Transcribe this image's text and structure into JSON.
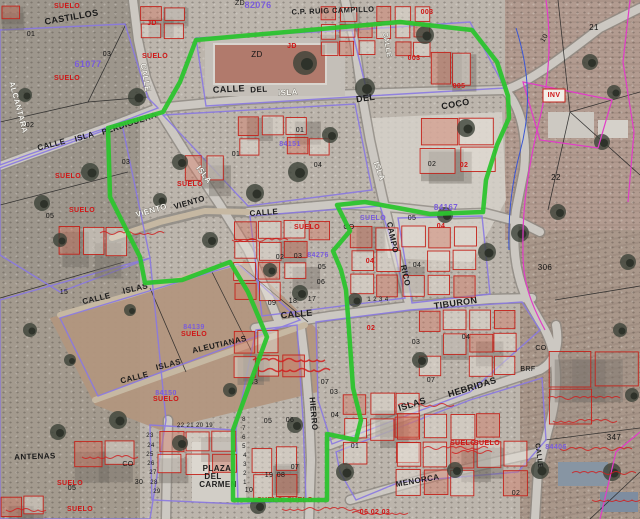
{
  "map": {
    "description": "Cadastral parcel overlay on aerial orthophoto",
    "boundary_color_green": "#2cc42e",
    "building_outline_color": "#c4231b",
    "block_outline_color": "#8a79e2",
    "annotation_magenta": "#e23cc8",
    "annotation_blue": "#3a56d4",
    "labels": [
      {
        "t": "CASTILLOS",
        "x": 72,
        "y": 20,
        "r": -10,
        "c": "st",
        "s": 9
      },
      {
        "t": "CALLE",
        "x": 52,
        "y": 147,
        "r": -14,
        "c": "st",
        "s": 8
      },
      {
        "t": "ISLA",
        "x": 85,
        "y": 139,
        "r": -16,
        "c": "st",
        "s": 8
      },
      {
        "t": "PERDIGUERA",
        "x": 130,
        "y": 126,
        "r": -18,
        "c": "st",
        "s": 8
      },
      {
        "t": "CALLE",
        "x": 229,
        "y": 92,
        "r": -3,
        "c": "st",
        "s": 9
      },
      {
        "t": "DEL",
        "x": 259,
        "y": 92,
        "r": -3,
        "c": "st",
        "s": 8
      },
      {
        "t": "DEL",
        "x": 366,
        "y": 101,
        "r": -8,
        "c": "st",
        "s": 9
      },
      {
        "t": "COCO",
        "x": 456,
        "y": 107,
        "r": -10,
        "c": "st",
        "s": 9
      },
      {
        "t": "TIBURON",
        "x": 456,
        "y": 306,
        "r": -8,
        "c": "st",
        "s": 9
      },
      {
        "t": "CALLE",
        "x": 297,
        "y": 317,
        "r": -5,
        "c": "st",
        "s": 9
      },
      {
        "t": "ISLAS",
        "x": 413,
        "y": 407,
        "r": -17,
        "c": "st",
        "s": 9
      },
      {
        "t": "HEBRIDAS",
        "x": 473,
        "y": 390,
        "r": -17,
        "c": "st",
        "s": 9
      },
      {
        "t": "CALLE",
        "x": 97,
        "y": 301,
        "r": -13,
        "c": "st",
        "s": 8
      },
      {
        "t": "ISLAS",
        "x": 136,
        "y": 291,
        "r": -13,
        "c": "st",
        "s": 8
      },
      {
        "t": "CALLE",
        "x": 135,
        "y": 380,
        "r": -14,
        "c": "st",
        "s": 8
      },
      {
        "t": "ISLAS",
        "x": 169,
        "y": 367,
        "r": -14,
        "c": "st",
        "s": 8
      },
      {
        "t": "ALEUTIANAS",
        "x": 220,
        "y": 347,
        "r": -13,
        "c": "st",
        "s": 8
      },
      {
        "t": "VIENTO",
        "x": 190,
        "y": 205,
        "r": -16,
        "c": "st",
        "s": 8
      },
      {
        "t": "CALLE",
        "x": 264,
        "y": 215,
        "r": -4,
        "c": "st",
        "s": 8
      },
      {
        "t": "HIERRO",
        "x": 311,
        "y": 414,
        "r": 85,
        "c": "st",
        "s": 8
      },
      {
        "t": "CAMPO",
        "x": 390,
        "y": 238,
        "r": 78,
        "c": "st",
        "s": 8
      },
      {
        "t": "RICO",
        "x": 403,
        "y": 276,
        "r": 78,
        "c": "st",
        "s": 8
      },
      {
        "t": "PLAZA",
        "x": 217,
        "y": 471,
        "r": 0,
        "c": "st",
        "s": 8
      },
      {
        "t": "DEL",
        "x": 213,
        "y": 479,
        "r": 0,
        "c": "st",
        "s": 8
      },
      {
        "t": "CARMEN",
        "x": 218,
        "y": 487,
        "r": 0,
        "c": "st",
        "s": 8
      },
      {
        "t": "ANTENAS",
        "x": 35,
        "y": 459,
        "r": -2,
        "c": "st",
        "s": 8
      },
      {
        "t": "MENORCA",
        "x": 418,
        "y": 483,
        "r": -10,
        "c": "st",
        "s": 8
      },
      {
        "t": "CALLE",
        "x": 537,
        "y": 456,
        "r": 82,
        "c": "st",
        "s": 7
      },
      {
        "t": "C.P. RUIG CAMPILLO",
        "x": 333,
        "y": 13,
        "r": -2,
        "c": "st",
        "s": 7.5
      },
      {
        "t": "ALCANTARA",
        "x": 16,
        "y": 108,
        "r": 75,
        "c": "wh",
        "s": 8
      },
      {
        "t": "CALLE",
        "x": 143,
        "y": 78,
        "r": 80,
        "c": "wh",
        "s": 8
      },
      {
        "t": "VIENTO",
        "x": 152,
        "y": 213,
        "r": -16,
        "c": "wh",
        "s": 8
      },
      {
        "t": "ISLA",
        "x": 288,
        "y": 95,
        "r": -3,
        "c": "wh",
        "s": 8
      },
      {
        "t": "ISLA",
        "x": 202,
        "y": 176,
        "r": 52,
        "c": "wh",
        "s": 8
      },
      {
        "t": "ISLA",
        "x": 377,
        "y": 172,
        "r": 70,
        "c": "wh",
        "s": 8
      },
      {
        "t": "CALLE",
        "x": 385,
        "y": 45,
        "r": 80,
        "c": "wh",
        "s": 7
      },
      {
        "t": "ZD",
        "x": 257,
        "y": 57,
        "r": 0,
        "c": "bk",
        "s": 8
      },
      {
        "t": "ZD",
        "x": 240,
        "y": 5,
        "r": 0,
        "c": "bk",
        "s": 7
      },
      {
        "t": "01",
        "x": 31,
        "y": 36,
        "r": 0,
        "c": "bk",
        "s": 7
      },
      {
        "t": "02",
        "x": 30,
        "y": 127,
        "r": 0,
        "c": "bk",
        "s": 7
      },
      {
        "t": "15",
        "x": 64,
        "y": 294,
        "r": 0,
        "c": "bk",
        "s": 7
      },
      {
        "t": "05",
        "x": 50,
        "y": 218,
        "r": 0,
        "c": "bk",
        "s": 7
      },
      {
        "t": "03",
        "x": 126,
        "y": 164,
        "r": 0,
        "c": "bk",
        "s": 7
      },
      {
        "t": "03",
        "x": 107,
        "y": 56,
        "r": 0,
        "c": "bk",
        "s": 7
      },
      {
        "t": "01",
        "x": 236,
        "y": 156,
        "r": 0,
        "c": "bk",
        "s": 7
      },
      {
        "t": "01",
        "x": 300,
        "y": 132,
        "r": 0,
        "c": "bk",
        "s": 7
      },
      {
        "t": "04",
        "x": 318,
        "y": 167,
        "r": 0,
        "c": "bk",
        "s": 7
      },
      {
        "t": "02",
        "x": 432,
        "y": 166,
        "r": 0,
        "c": "bk",
        "s": 7
      },
      {
        "t": "05",
        "x": 412,
        "y": 220,
        "r": 0,
        "c": "bk",
        "s": 7
      },
      {
        "t": "21",
        "x": 594,
        "y": 30,
        "r": 0,
        "c": "bk",
        "s": 8
      },
      {
        "t": "22",
        "x": 556,
        "y": 180,
        "r": 0,
        "c": "bk",
        "s": 8
      },
      {
        "t": "306",
        "x": 545,
        "y": 270,
        "r": 0,
        "c": "bk",
        "s": 8
      },
      {
        "t": "347",
        "x": 614,
        "y": 440,
        "r": 0,
        "c": "bk",
        "s": 8
      },
      {
        "t": "10",
        "x": 546,
        "y": 39,
        "r": -60,
        "c": "bk",
        "s": 7
      },
      {
        "t": "09",
        "x": 272,
        "y": 305,
        "r": 0,
        "c": "bk",
        "s": 7
      },
      {
        "t": "18",
        "x": 293,
        "y": 303,
        "r": 0,
        "c": "bk",
        "s": 7
      },
      {
        "t": "17",
        "x": 312,
        "y": 301,
        "r": 0,
        "c": "bk",
        "s": 7
      },
      {
        "t": "1 2 3 4",
        "x": 378,
        "y": 301,
        "r": 0,
        "c": "bk",
        "s": 6
      },
      {
        "t": "33",
        "x": 254,
        "y": 384,
        "r": 0,
        "c": "bk",
        "s": 7
      },
      {
        "t": "02",
        "x": 280,
        "y": 259,
        "r": 0,
        "c": "bk",
        "s": 7
      },
      {
        "t": "03",
        "x": 298,
        "y": 258,
        "r": 0,
        "c": "bk",
        "s": 7
      },
      {
        "t": "05",
        "x": 322,
        "y": 269,
        "r": 0,
        "c": "bk",
        "s": 7
      },
      {
        "t": "06",
        "x": 321,
        "y": 284,
        "r": 0,
        "c": "bk",
        "s": 7
      },
      {
        "t": "04",
        "x": 417,
        "y": 267,
        "r": 0,
        "c": "bk",
        "s": 7
      },
      {
        "t": "03",
        "x": 416,
        "y": 344,
        "r": 0,
        "c": "bk",
        "s": 7
      },
      {
        "t": "04",
        "x": 466,
        "y": 339,
        "r": 0,
        "c": "bk",
        "s": 7
      },
      {
        "t": "07",
        "x": 431,
        "y": 382,
        "r": 0,
        "c": "bk",
        "s": 7
      },
      {
        "t": "07",
        "x": 325,
        "y": 384,
        "r": 0,
        "c": "bk",
        "s": 7
      },
      {
        "t": "03",
        "x": 334,
        "y": 394,
        "r": 0,
        "c": "bk",
        "s": 7
      },
      {
        "t": "04",
        "x": 335,
        "y": 417,
        "r": 0,
        "c": "bk",
        "s": 7
      },
      {
        "t": "05",
        "x": 268,
        "y": 423,
        "r": 0,
        "c": "bk",
        "s": 7
      },
      {
        "t": "06",
        "x": 290,
        "y": 422,
        "r": 0,
        "c": "bk",
        "s": 7
      },
      {
        "t": "07",
        "x": 295,
        "y": 469,
        "r": 0,
        "c": "bk",
        "s": 7
      },
      {
        "t": "19",
        "x": 269,
        "y": 477,
        "r": 0,
        "c": "bk",
        "s": 7
      },
      {
        "t": "08",
        "x": 281,
        "y": 477,
        "r": 0,
        "c": "bk",
        "s": 7
      },
      {
        "t": "10",
        "x": 249,
        "y": 492,
        "r": 0,
        "c": "bk",
        "s": 7
      },
      {
        "t": "30",
        "x": 139,
        "y": 484,
        "r": 0,
        "c": "bk",
        "s": 7
      },
      {
        "t": "22 21 20 19",
        "x": 195,
        "y": 427,
        "r": 0,
        "c": "bk",
        "s": 6
      },
      {
        "t": "23",
        "x": 150,
        "y": 437,
        "r": 0,
        "c": "bk",
        "s": 6
      },
      {
        "t": "24",
        "x": 151,
        "y": 447,
        "r": 0,
        "c": "bk",
        "s": 6
      },
      {
        "t": "25",
        "x": 150,
        "y": 456,
        "r": 0,
        "c": "bk",
        "s": 6
      },
      {
        "t": "26",
        "x": 151,
        "y": 465,
        "r": 0,
        "c": "bk",
        "s": 6
      },
      {
        "t": "27",
        "x": 153,
        "y": 474,
        "r": 0,
        "c": "bk",
        "s": 6
      },
      {
        "t": "28",
        "x": 154,
        "y": 484,
        "r": 0,
        "c": "bk",
        "s": 6
      },
      {
        "t": "29",
        "x": 157,
        "y": 493,
        "r": 0,
        "c": "bk",
        "s": 6
      },
      {
        "t": "8",
        "x": 244,
        "y": 421,
        "r": 0,
        "c": "bk",
        "s": 6
      },
      {
        "t": "7",
        "x": 244,
        "y": 430,
        "r": 0,
        "c": "bk",
        "s": 6
      },
      {
        "t": "6",
        "x": 244,
        "y": 439,
        "r": 0,
        "c": "bk",
        "s": 6
      },
      {
        "t": "5",
        "x": 244,
        "y": 448,
        "r": 0,
        "c": "bk",
        "s": 6
      },
      {
        "t": "4",
        "x": 245,
        "y": 457,
        "r": 0,
        "c": "bk",
        "s": 6
      },
      {
        "t": "3",
        "x": 245,
        "y": 466,
        "r": 0,
        "c": "bk",
        "s": 6
      },
      {
        "t": "2",
        "x": 245,
        "y": 475,
        "r": 0,
        "c": "bk",
        "s": 6
      },
      {
        "t": "1",
        "x": 245,
        "y": 484,
        "r": 0,
        "c": "bk",
        "s": 6
      },
      {
        "t": "02",
        "x": 516,
        "y": 495,
        "r": 0,
        "c": "bk",
        "s": 7
      },
      {
        "t": "05",
        "x": 72,
        "y": 490,
        "r": 0,
        "c": "bk",
        "s": 7
      },
      {
        "t": "CO",
        "x": 128,
        "y": 466,
        "r": 0,
        "c": "bk",
        "s": 7
      },
      {
        "t": "CO",
        "x": 349,
        "y": 229,
        "r": 0,
        "c": "bk",
        "s": 7
      },
      {
        "t": "CO",
        "x": 541,
        "y": 350,
        "r": 0,
        "c": "bk",
        "s": 7
      },
      {
        "t": "BRF",
        "x": 528,
        "y": 371,
        "r": 0,
        "c": "bk",
        "s": 7
      },
      {
        "t": "01",
        "x": 355,
        "y": 448,
        "r": 0,
        "c": "bk",
        "s": 7
      },
      {
        "t": "SUELO",
        "x": 67,
        "y": 8,
        "r": 0,
        "c": "rd",
        "s": 7
      },
      {
        "t": "SUELO",
        "x": 67,
        "y": 80,
        "r": 0,
        "c": "rd",
        "s": 7
      },
      {
        "t": "SUELO",
        "x": 68,
        "y": 178,
        "r": 0,
        "c": "rd",
        "s": 7
      },
      {
        "t": "SUELO",
        "x": 82,
        "y": 212,
        "r": 0,
        "c": "rd",
        "s": 7
      },
      {
        "t": "SUELO",
        "x": 155,
        "y": 58,
        "r": 0,
        "c": "rd",
        "s": 7
      },
      {
        "t": "SUELO",
        "x": 190,
        "y": 186,
        "r": 0,
        "c": "rd",
        "s": 7
      },
      {
        "t": "SUELO",
        "x": 307,
        "y": 229,
        "r": 0,
        "c": "rd",
        "s": 7
      },
      {
        "t": "SUELO",
        "x": 194,
        "y": 336,
        "r": 0,
        "c": "rd",
        "s": 7
      },
      {
        "t": "SUELO",
        "x": 166,
        "y": 401,
        "r": 0,
        "c": "rd",
        "s": 7
      },
      {
        "t": "SUELO",
        "x": 463,
        "y": 445,
        "r": 0,
        "c": "rd",
        "s": 7
      },
      {
        "t": "SUELO",
        "x": 487,
        "y": 445,
        "r": 0,
        "c": "rd",
        "s": 7
      },
      {
        "t": "SUELO",
        "x": 70,
        "y": 485,
        "r": 0,
        "c": "rd",
        "s": 7
      },
      {
        "t": "SUELO",
        "x": 80,
        "y": 511,
        "r": 0,
        "c": "rd",
        "s": 7
      },
      {
        "t": "SUELO",
        "x": 270,
        "y": 502,
        "r": 0,
        "c": "rd",
        "s": 7
      },
      {
        "t": "SUELO",
        "x": 300,
        "y": 502,
        "r": 0,
        "c": "rd",
        "s": 7
      },
      {
        "t": "JD",
        "x": 152,
        "y": 25,
        "r": 0,
        "c": "rd",
        "s": 7
      },
      {
        "t": "JD",
        "x": 292,
        "y": 48,
        "r": 0,
        "c": "rd",
        "s": 7
      },
      {
        "t": "003",
        "x": 427,
        "y": 14,
        "r": 0,
        "c": "rd",
        "s": 7
      },
      {
        "t": "003",
        "x": 414,
        "y": 60,
        "r": 0,
        "c": "rd",
        "s": 7
      },
      {
        "t": "005",
        "x": 459,
        "y": 88,
        "r": 0,
        "c": "rd",
        "s": 7
      },
      {
        "t": "02",
        "x": 464,
        "y": 167,
        "r": 0,
        "c": "rd",
        "s": 7
      },
      {
        "t": "04",
        "x": 370,
        "y": 263,
        "r": 0,
        "c": "rd",
        "s": 7
      },
      {
        "t": "04",
        "x": 441,
        "y": 228,
        "r": 0,
        "c": "rd",
        "s": 7
      },
      {
        "t": "02",
        "x": 371,
        "y": 330,
        "r": 0,
        "c": "rd",
        "s": 7
      },
      {
        "t": "INV",
        "x": 554,
        "y": 97,
        "r": 0,
        "c": "rd",
        "s": 7
      },
      {
        "t": "06  02  03",
        "x": 375,
        "y": 514,
        "r": 0,
        "c": "rd",
        "s": 7
      },
      {
        "t": "82076",
        "x": 258,
        "y": 8,
        "r": 0,
        "c": "pu",
        "s": 9
      },
      {
        "t": "61077",
        "x": 88,
        "y": 67,
        "r": 0,
        "c": "pu",
        "s": 9
      },
      {
        "t": "84167",
        "x": 446,
        "y": 210,
        "r": 0,
        "c": "pu",
        "s": 8
      },
      {
        "t": "SUELO",
        "x": 373,
        "y": 220,
        "r": 0,
        "c": "pu",
        "s": 7
      },
      {
        "t": "84276",
        "x": 318,
        "y": 257,
        "r": 0,
        "c": "pu",
        "s": 7
      },
      {
        "t": "84139",
        "x": 194,
        "y": 329,
        "r": 0,
        "c": "pu",
        "s": 7
      },
      {
        "t": "84150",
        "x": 166,
        "y": 395,
        "r": 0,
        "c": "pu",
        "s": 7
      },
      {
        "t": "84406",
        "x": 556,
        "y": 449,
        "r": 0,
        "c": "pu",
        "s": 7
      },
      {
        "t": "84151",
        "x": 290,
        "y": 146,
        "r": 0,
        "c": "pu",
        "s": 7
      }
    ]
  }
}
